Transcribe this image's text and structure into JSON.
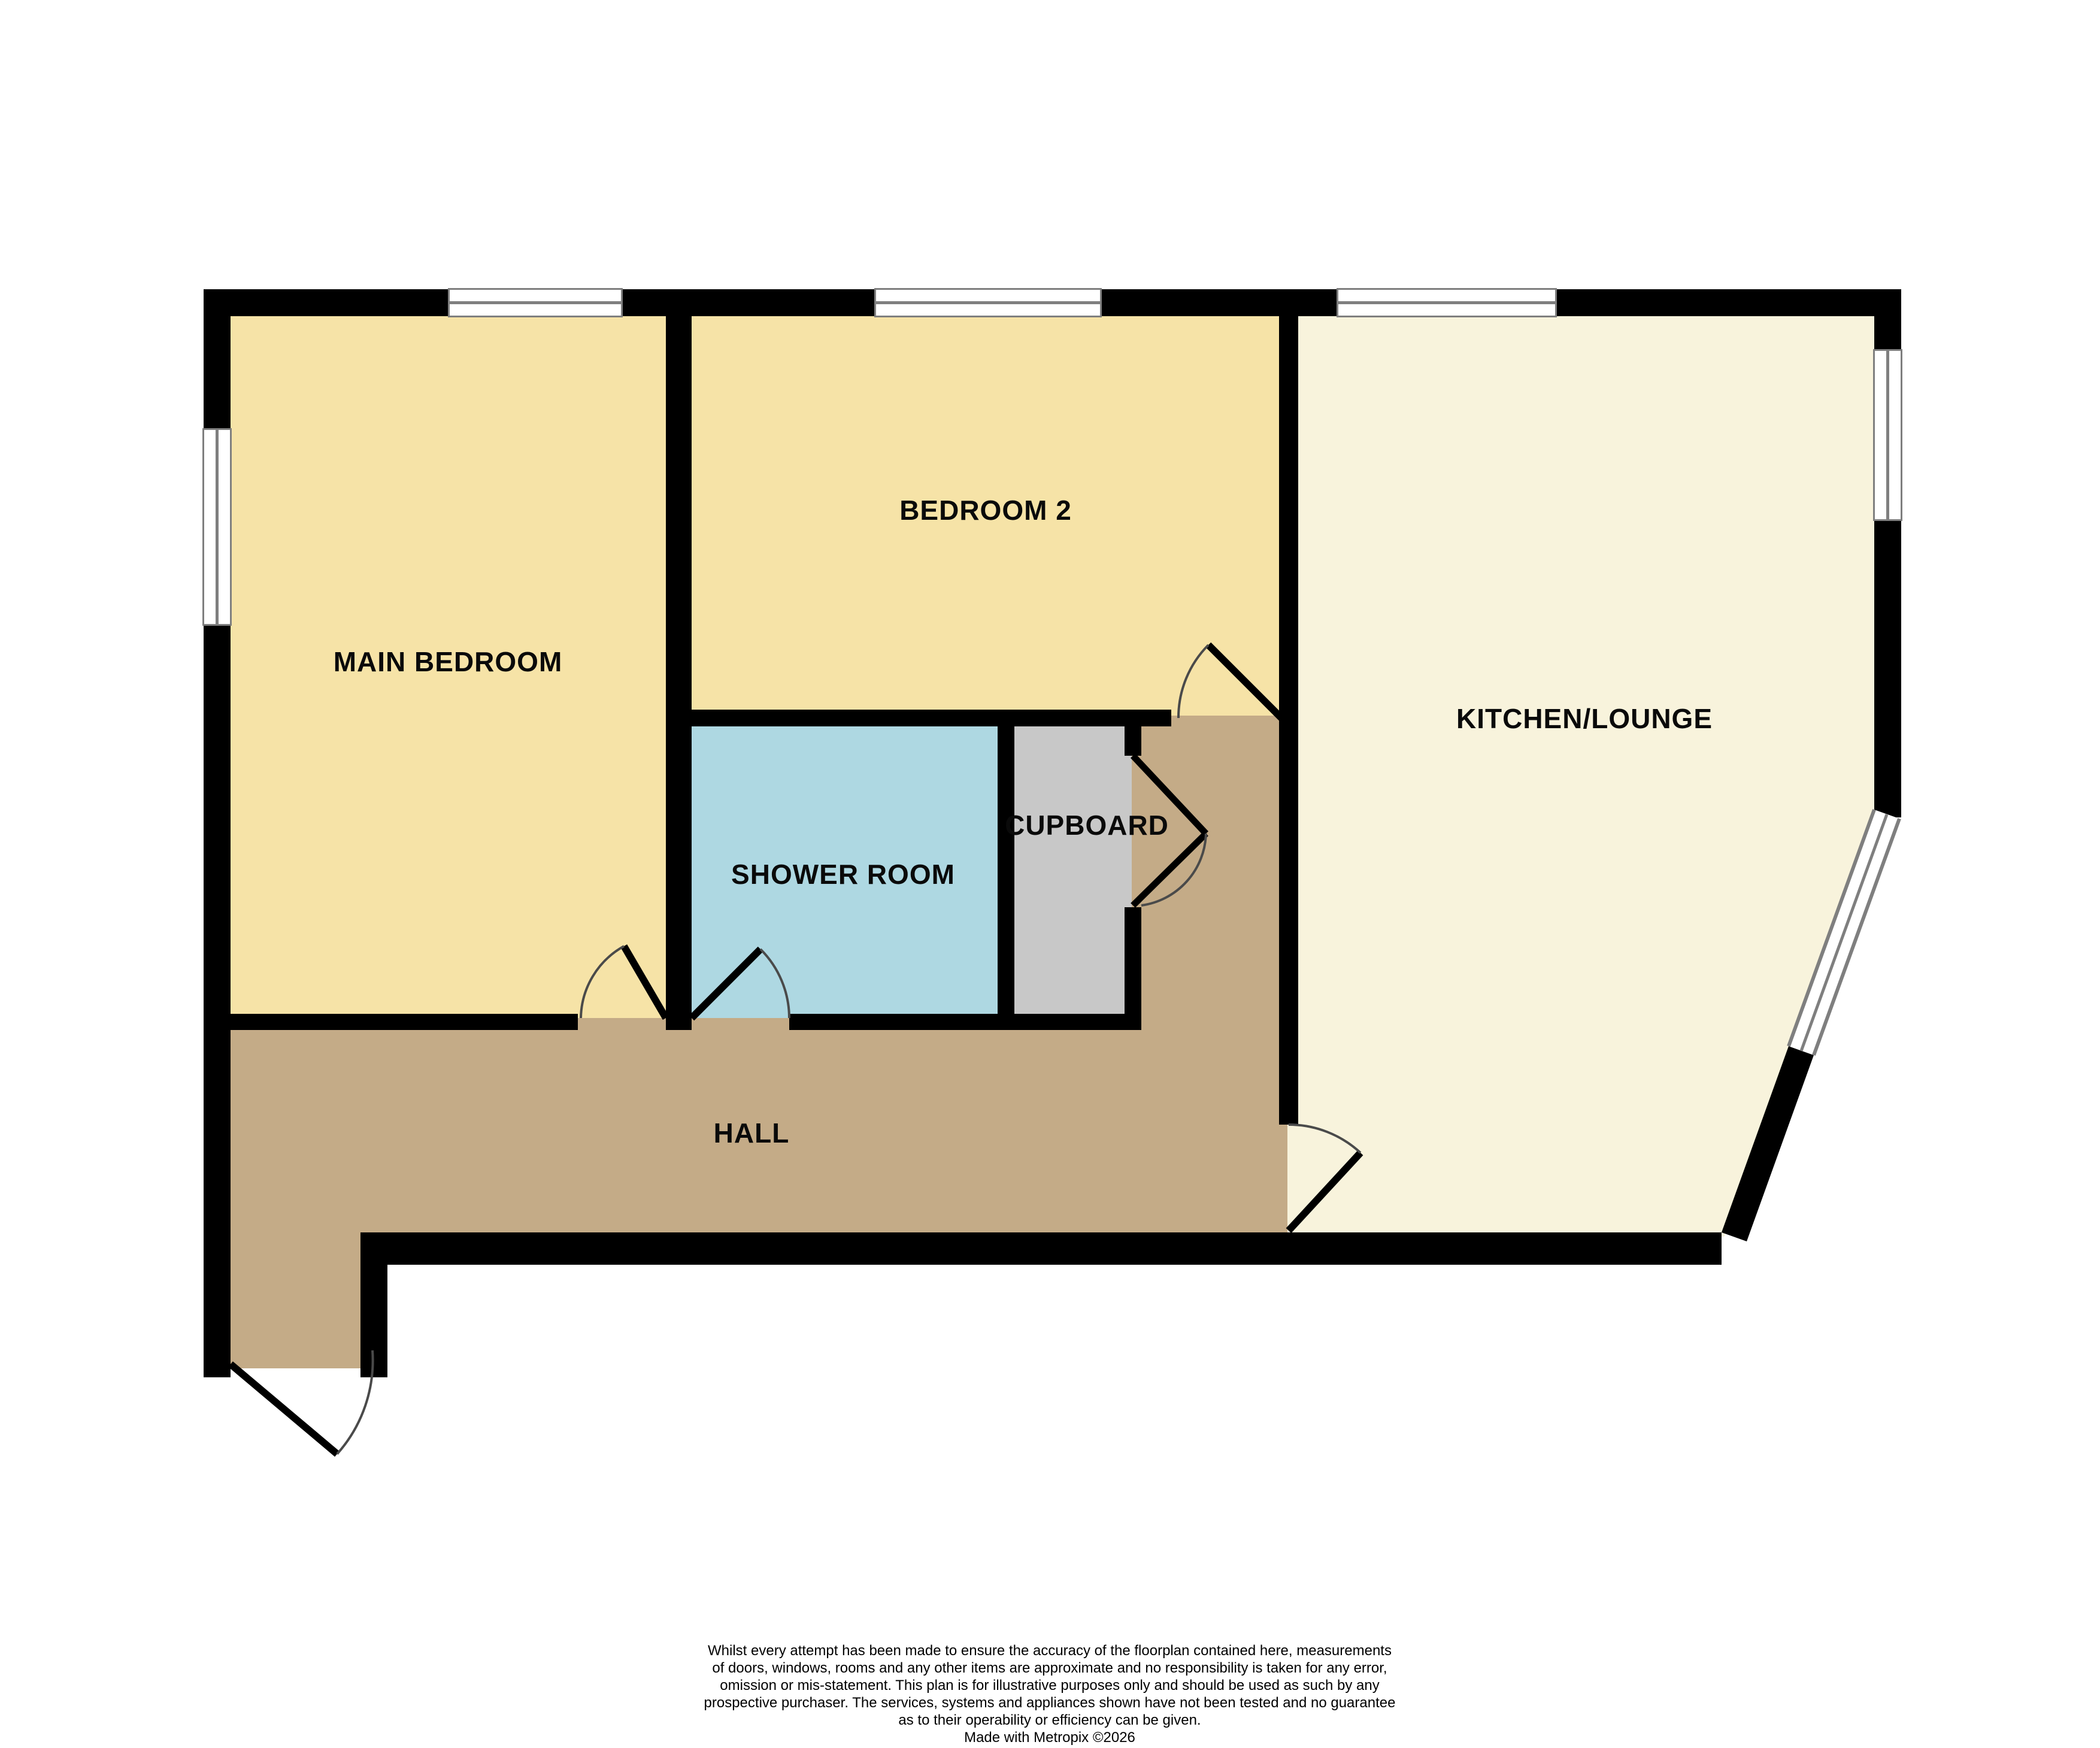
{
  "plan": {
    "colors": {
      "background": "#ffffff",
      "wall": "#000000",
      "window_frame": "#7f7f7f",
      "door_arc": "#4a4a4a"
    },
    "rooms": {
      "main_bedroom": {
        "label": "MAIN BEDROOM",
        "color": "#f6e3a7"
      },
      "bedroom_2": {
        "label": "BEDROOM 2",
        "color": "#f6e3a7"
      },
      "kitchen_lounge": {
        "label": "KITCHEN/LOUNGE",
        "color": "#f8f3dc"
      },
      "shower_room": {
        "label": "SHOWER ROOM",
        "color": "#aed8e2"
      },
      "cupboard": {
        "label": "CUPBOARD",
        "color": "#c8c8c8"
      },
      "hall": {
        "label": "HALL",
        "color": "#c4ab87"
      }
    }
  },
  "footer": {
    "lines": [
      "Whilst every attempt has been made to ensure the accuracy of the floorplan contained here, measurements",
      "of doors, windows, rooms and any other items are approximate and no responsibility is taken for any error,",
      "omission or mis-statement. This plan is for illustrative purposes only and should be used as such by any",
      "prospective purchaser. The services, systems and appliances shown have not been tested and no guarantee",
      "as to their operability or efficiency can be given.",
      "Made with Metropix ©2026"
    ]
  }
}
